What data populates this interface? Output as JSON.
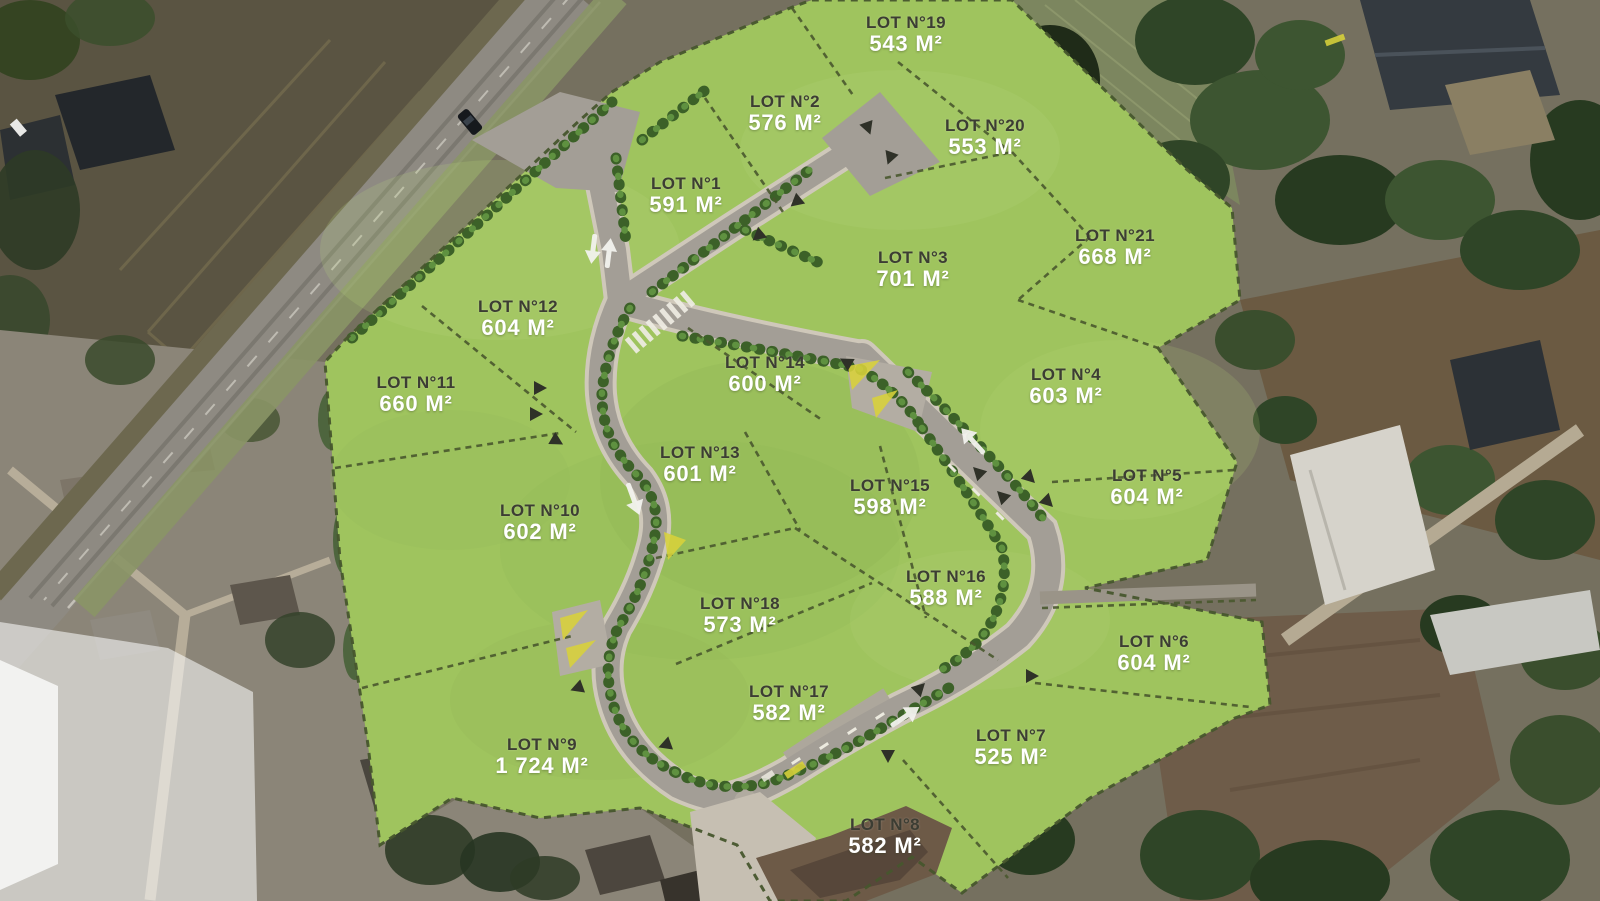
{
  "map": {
    "description": "Aerial land subdivision plan with 21 numbered lots",
    "unit": "M²",
    "lot_label_prefix": "LOT N°",
    "colors": {
      "lot_green": "#9fc45e",
      "lot_name_text": "#3c3d33",
      "lot_area_text": "#ffffff",
      "road": "#a39e96",
      "hedge": "#3c6128",
      "dirt": "#6d5a47"
    },
    "lots": [
      {
        "id": 1,
        "label": "LOT N°1",
        "area": "591 M²",
        "x": 686,
        "y": 196
      },
      {
        "id": 2,
        "label": "LOT N°2",
        "area": "576 M²",
        "x": 785,
        "y": 114
      },
      {
        "id": 3,
        "label": "LOT N°3",
        "area": "701 M²",
        "x": 913,
        "y": 270
      },
      {
        "id": 4,
        "label": "LOT N°4",
        "area": "603 M²",
        "x": 1066,
        "y": 387
      },
      {
        "id": 5,
        "label": "LOT N°5",
        "area": "604 M²",
        "x": 1147,
        "y": 488
      },
      {
        "id": 6,
        "label": "LOT N°6",
        "area": "604 M²",
        "x": 1154,
        "y": 654
      },
      {
        "id": 7,
        "label": "LOT N°7",
        "area": "525 M²",
        "x": 1011,
        "y": 748
      },
      {
        "id": 8,
        "label": "LOT N°8",
        "area": "582 M²",
        "x": 885,
        "y": 837
      },
      {
        "id": 9,
        "label": "LOT N°9",
        "area": "1 724 M²",
        "x": 542,
        "y": 757
      },
      {
        "id": 10,
        "label": "LOT N°10",
        "area": "602 M²",
        "x": 540,
        "y": 523
      },
      {
        "id": 11,
        "label": "LOT N°11",
        "area": "660 M²",
        "x": 416,
        "y": 395
      },
      {
        "id": 12,
        "label": "LOT N°12",
        "area": "604 M²",
        "x": 518,
        "y": 319
      },
      {
        "id": 13,
        "label": "LOT N°13",
        "area": "601 M²",
        "x": 700,
        "y": 465
      },
      {
        "id": 14,
        "label": "LOT N°14",
        "area": "600 M²",
        "x": 765,
        "y": 375
      },
      {
        "id": 15,
        "label": "LOT N°15",
        "area": "598 M²",
        "x": 890,
        "y": 498
      },
      {
        "id": 16,
        "label": "LOT N°16",
        "area": "588 M²",
        "x": 946,
        "y": 589
      },
      {
        "id": 17,
        "label": "LOT N°17",
        "area": "582 M²",
        "x": 789,
        "y": 704
      },
      {
        "id": 18,
        "label": "LOT N°18",
        "area": "573 M²",
        "x": 740,
        "y": 616
      },
      {
        "id": 19,
        "label": "LOT N°19",
        "area": "543 M²",
        "x": 906,
        "y": 35
      },
      {
        "id": 20,
        "label": "LOT N°20",
        "area": "553 M²",
        "x": 985,
        "y": 138
      },
      {
        "id": 21,
        "label": "LOT N°21",
        "area": "668 M²",
        "x": 1115,
        "y": 248
      }
    ]
  }
}
